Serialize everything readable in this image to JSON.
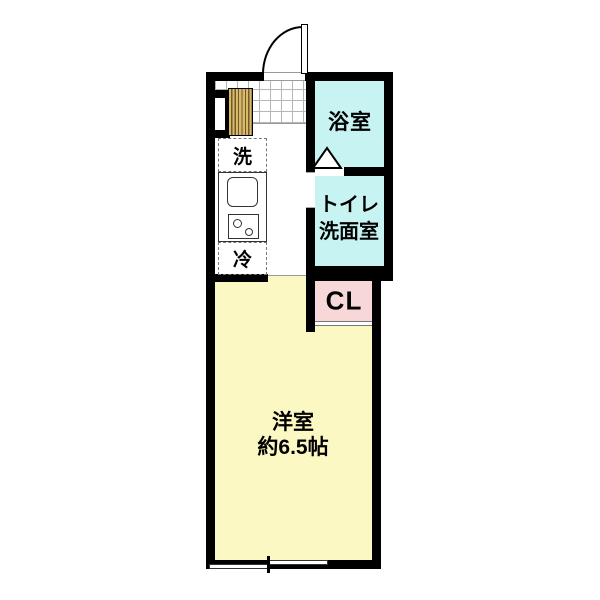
{
  "rooms": {
    "bathroom": {
      "label": "浴室",
      "color": "#c7f4f3"
    },
    "toilet_washroom": {
      "lines": [
        "トイレ",
        "洗面室"
      ],
      "color": "#c7f4f3"
    },
    "closet": {
      "label": "CL",
      "color": "#f8d7d8"
    },
    "western_room": {
      "lines": [
        "洋室",
        "約6.5帖"
      ],
      "color": "#fbf8c3"
    }
  },
  "kitchen": {
    "washer_space_label": "洗",
    "fridge_space_label": "冷"
  },
  "palette": {
    "wall": "#000000",
    "tile_line": "#b5b5b5",
    "cabinet_wood": "#d9b967"
  },
  "features": {
    "entrance_door": "hinged-door-arc",
    "bathroom_door": "folding-door-triangle",
    "main_window": "sliding-window",
    "closet_door": "double-line-opening"
  }
}
